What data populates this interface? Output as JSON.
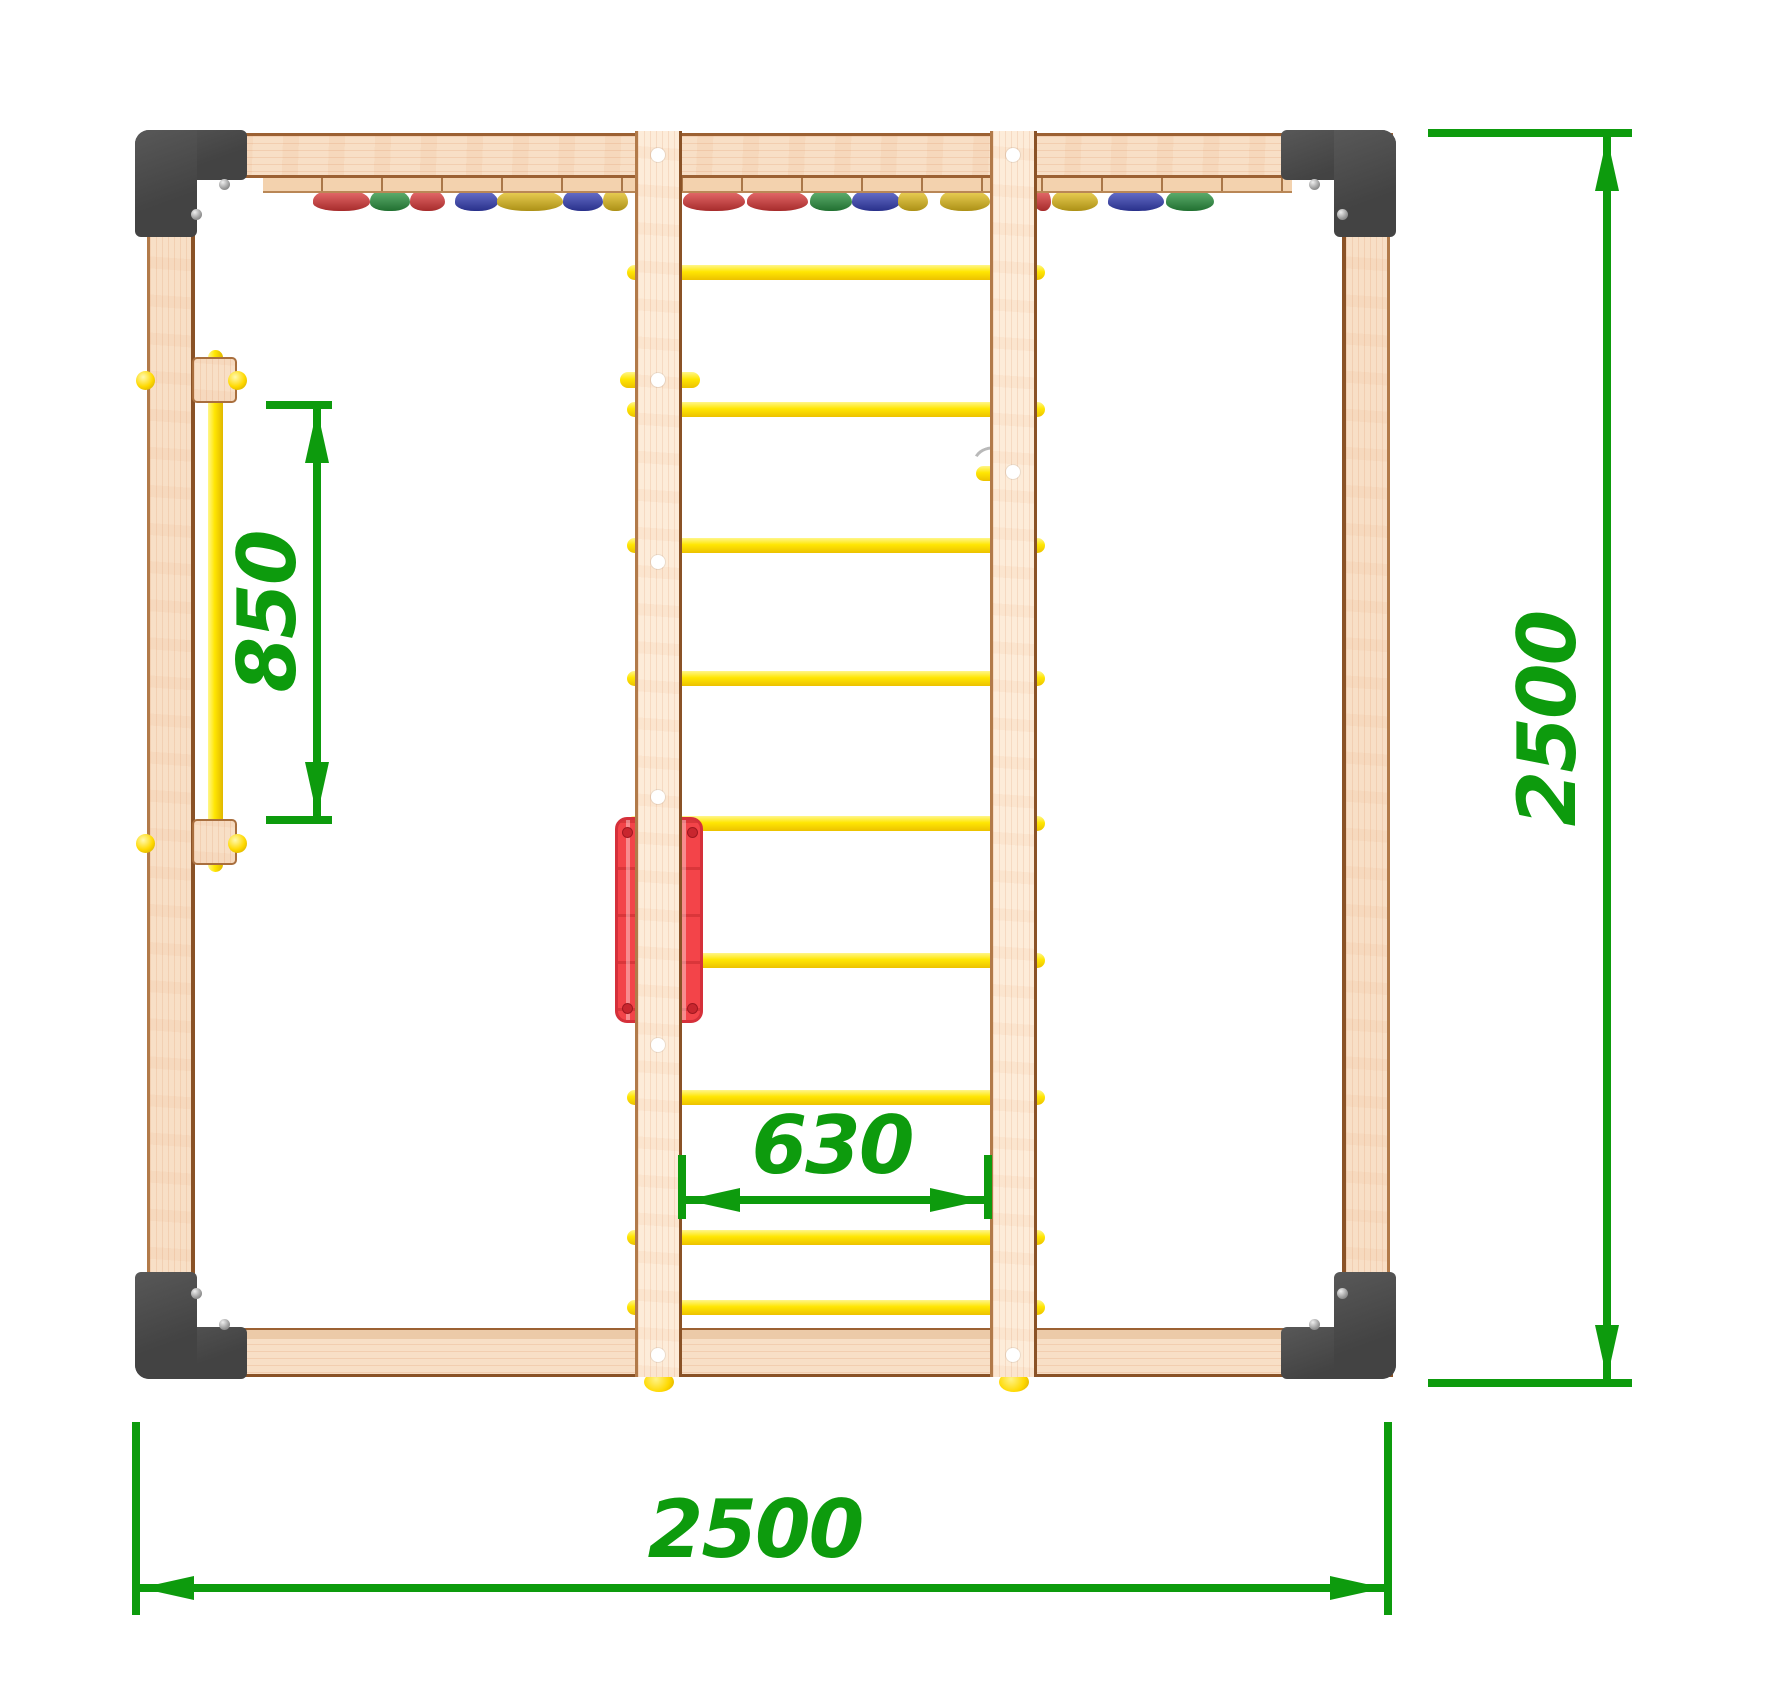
{
  "drawing": {
    "title": "playground-frame-top-view",
    "dimensions": {
      "left_bar_length": "850",
      "ladder_inner_width": "630",
      "frame_width": "2500",
      "frame_depth": "2500"
    }
  },
  "colors": {
    "dim": "#0d9b0d",
    "wood": "#f8dfc6",
    "wood_edge": "#9c6133",
    "bracket": "#474747",
    "yellow": "#ffe602",
    "red_panel": "#f34449",
    "hold_red": "#e63c3c",
    "hold_green": "#2d9b43",
    "hold_blue": "#3843c0",
    "hold_yellow": "#eec81e"
  },
  "ladder": {
    "rung_count": 9,
    "rungs_y": [
      272,
      409,
      545,
      678,
      823,
      960,
      1097,
      1237,
      1307
    ]
  },
  "holds": [
    {
      "x": 313,
      "w": 57,
      "color": "red"
    },
    {
      "x": 370,
      "w": 40,
      "color": "green"
    },
    {
      "x": 410,
      "w": 35,
      "color": "red"
    },
    {
      "x": 455,
      "w": 43,
      "color": "blue"
    },
    {
      "x": 497,
      "w": 66,
      "color": "yellow"
    },
    {
      "x": 563,
      "w": 40,
      "color": "blue"
    },
    {
      "x": 603,
      "w": 25,
      "color": "yellow"
    },
    {
      "x": 683,
      "w": 62,
      "color": "red"
    },
    {
      "x": 747,
      "w": 61,
      "color": "red"
    },
    {
      "x": 810,
      "w": 42,
      "color": "green"
    },
    {
      "x": 852,
      "w": 48,
      "color": "blue"
    },
    {
      "x": 898,
      "w": 30,
      "color": "yellow"
    },
    {
      "x": 940,
      "w": 50,
      "color": "yellow"
    },
    {
      "x": 1035,
      "w": 16,
      "color": "red"
    },
    {
      "x": 1052,
      "w": 46,
      "color": "yellow"
    },
    {
      "x": 1108,
      "w": 56,
      "color": "blue"
    },
    {
      "x": 1166,
      "w": 48,
      "color": "green"
    }
  ],
  "screw_holes": {
    "left_stile_x": 658,
    "left_y": [
      155,
      380,
      562,
      797,
      1045,
      1355
    ],
    "right_stile_x": 1013,
    "right_y": [
      155,
      472,
      1355
    ]
  },
  "bracket_screws": [
    [
      224,
      184
    ],
    [
      196,
      214
    ],
    [
      1314,
      184
    ],
    [
      1342,
      214
    ],
    [
      196,
      1293
    ],
    [
      224,
      1324
    ],
    [
      1342,
      1293
    ],
    [
      1314,
      1324
    ]
  ],
  "panel_screws": [
    [
      627,
      832
    ],
    [
      692,
      832
    ],
    [
      627,
      1008
    ],
    [
      692,
      1008
    ]
  ]
}
